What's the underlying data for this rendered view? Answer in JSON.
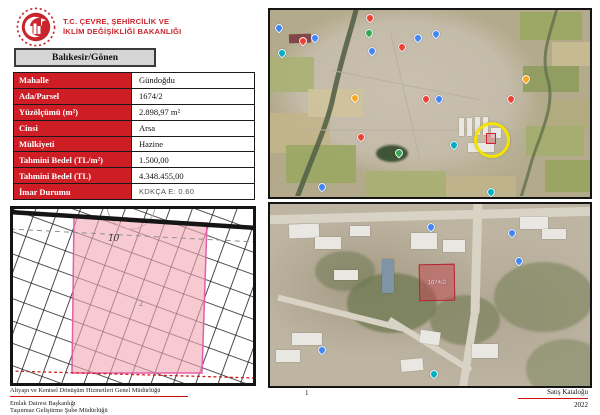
{
  "header": {
    "ministry_line1": "T.C. ÇEVRE, ŞEHİRCİLİK VE",
    "ministry_line2": "İKLİM DEĞİŞİKLİĞİ BAKANLIĞI"
  },
  "location": "Balıkesir/Gönen",
  "table": {
    "rows": [
      {
        "label": "Mahalle",
        "value": "Gündoğdu"
      },
      {
        "label": "Ada/Parsel",
        "value": "1674/2"
      },
      {
        "label": "Yüzölçümü (m²)",
        "value": "2.898,97 m²"
      },
      {
        "label": "Cinsi",
        "value": "Arsa"
      },
      {
        "label": "Mülkiyeti",
        "value": "Hazine"
      },
      {
        "label": "Tahmini Bedel (TL/m²)",
        "value": "1.500,00"
      },
      {
        "label": "Tahmini Bedel (TL)",
        "value": "4.348.455,00"
      },
      {
        "label": "İmar Durumu",
        "value": "KDKÇA E: 0.60",
        "alt": true
      }
    ]
  },
  "cadastral_map": {
    "block_label": "10",
    "parcel_label": "2"
  },
  "overview_map": {
    "pins": [
      {
        "x": 1.7,
        "y": 7.3,
        "c": "blue"
      },
      {
        "x": 9.2,
        "y": 14.2,
        "c": "red"
      },
      {
        "x": 12.7,
        "y": 12.6,
        "c": "blue"
      },
      {
        "x": 2.4,
        "y": 20.7,
        "c": "teal"
      },
      {
        "x": 29.9,
        "y": 2.2,
        "c": "red"
      },
      {
        "x": 29.6,
        "y": 9.9,
        "c": "green"
      },
      {
        "x": 30.6,
        "y": 19.6,
        "c": "blue"
      },
      {
        "x": 40.0,
        "y": 17.5,
        "c": "red"
      },
      {
        "x": 45.0,
        "y": 12.6,
        "c": "blue"
      },
      {
        "x": 50.6,
        "y": 10.5,
        "c": "blue"
      },
      {
        "x": 25.2,
        "y": 44.9,
        "c": "orange"
      },
      {
        "x": 47.5,
        "y": 45.4,
        "c": "red"
      },
      {
        "x": 51.6,
        "y": 45.4,
        "c": "blue"
      },
      {
        "x": 78.8,
        "y": 34.7,
        "c": "orange"
      },
      {
        "x": 74.1,
        "y": 45.4,
        "c": "red"
      },
      {
        "x": 27.1,
        "y": 65.9,
        "c": "red"
      },
      {
        "x": 56.3,
        "y": 70.2,
        "c": "teal"
      },
      {
        "x": 39.0,
        "y": 74.5,
        "c": "green"
      },
      {
        "x": 14.9,
        "y": 92.7,
        "c": "blue"
      },
      {
        "x": 67.9,
        "y": 95.0,
        "c": "teal"
      }
    ]
  },
  "detail_map": {
    "parcel_label": "1674/2",
    "pins": [
      {
        "x": 49.0,
        "y": 10.5,
        "c": "blue"
      },
      {
        "x": 74.5,
        "y": 14.0,
        "c": "blue"
      },
      {
        "x": 76.5,
        "y": 29.0,
        "c": "blue"
      },
      {
        "x": 15.0,
        "y": 78.0,
        "c": "blue"
      },
      {
        "x": 50.0,
        "y": 91.0,
        "c": "teal"
      }
    ]
  },
  "footer": {
    "org_line1": "Altyapı ve Kentsel Dönüşüm Hizmetleri Genel Müdürlüğü",
    "org_line2": "Emlak Dairesi Başkanlığı",
    "org_line3": "Taşınmaz Geliştirme Şube Müdürlüğü",
    "page_number": "1",
    "catalog_label": "Satış Kataloğu",
    "year": "2022"
  },
  "colors": {
    "brand_red": "#c9252d",
    "table_label_bg": "#cf1d26",
    "rule_red": "#cc1111",
    "highlight_yellow": "#f2e400",
    "cadastral_parcel_fill": "#f2a8b4",
    "cadastral_parcel_border": "#e35fa8",
    "detail_parcel_border": "#b5252f",
    "pin": {
      "blue": "#4285f4",
      "red": "#ea4335",
      "orange": "#f9a825",
      "green": "#34a853",
      "teal": "#00acc1"
    }
  }
}
